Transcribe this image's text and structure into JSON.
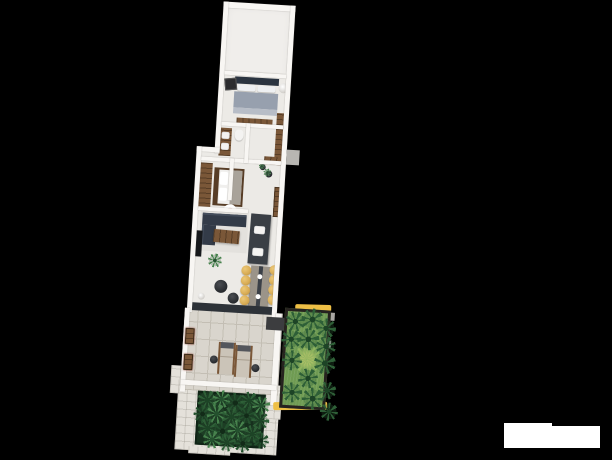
{
  "canvas": {
    "width": 612,
    "height": 460
  },
  "palette": {
    "bg": "#000000",
    "wall": "#f8f6f3",
    "floor": "#eceae6",
    "floorA": "#f0eeeb",
    "rug": "#e3e1dd",
    "patio": "#d9d5cd",
    "patioLine": "#c3beb4",
    "paving": "#e4e1da",
    "navy": "#2b3440",
    "sofa": "#333b48",
    "blanket": "#97a0ae",
    "pillow": "#eef0f2",
    "wood": "#7a5738",
    "woodDark": "#573d26",
    "charcoal": "#3a3f45",
    "tvBlack": "#17191c",
    "tableGrey": "#9b9489",
    "runner": "#3b4047",
    "chairYellow": "#d9ad56",
    "pouf": "#26292d",
    "grass": "#6f9b52",
    "grassLight": "#8fb45e",
    "palm": "#2e5f37",
    "palmDark": "#1d4426",
    "foliageBase": "#16301d",
    "foliageEdge": "#0f2315",
    "gardenBorder": "#26231f",
    "curbYellow": "#eebf45",
    "loungerBeige": "#cbc4b8",
    "greyObj": "#b8b6b2",
    "threshold": "#2d3238",
    "gate": "#3c3d3f",
    "toilet": "#f4f3f1",
    "pinkRug": "#e0b7ad",
    "white": "#ffffff"
  },
  "scene": {
    "rotation_deg": 3.5,
    "right_garden": {
      "palms": [
        {
          "x": 8,
          "y": 10,
          "r": 10,
          "rot": 12
        },
        {
          "x": 25,
          "y": 7,
          "r": 11,
          "rot": 40
        },
        {
          "x": 39,
          "y": 15,
          "r": 10,
          "rot": 80
        },
        {
          "x": 5,
          "y": 28,
          "r": 10,
          "rot": 22
        },
        {
          "x": 22,
          "y": 27,
          "r": 11,
          "rot": 65
        },
        {
          "x": 40,
          "y": 33,
          "r": 10,
          "rot": 5
        },
        {
          "x": 7,
          "y": 49,
          "r": 10,
          "rot": 33
        },
        {
          "x": 40,
          "y": 50,
          "r": 11,
          "rot": 50
        },
        {
          "x": 24,
          "y": 66,
          "r": 10,
          "rot": 15
        },
        {
          "x": 9,
          "y": 81,
          "r": 10,
          "rot": 70
        },
        {
          "x": 30,
          "y": 86,
          "r": 11,
          "rot": 28
        },
        {
          "x": 44,
          "y": 77,
          "r": 9,
          "rot": 55
        },
        {
          "x": 47,
          "y": 98,
          "r": 9,
          "rot": 35
        }
      ],
      "grass_tufts": [
        {
          "x": 22,
          "y": 47,
          "r": 14
        }
      ]
    },
    "bottom_garden": {
      "tufts": [
        {
          "x": 8,
          "y": 7,
          "r": 10,
          "v": "a",
          "rot": 10
        },
        {
          "x": 22,
          "y": 5,
          "r": 9,
          "v": "c",
          "rot": 44
        },
        {
          "x": 36,
          "y": 8,
          "r": 10,
          "v": "b",
          "rot": 70
        },
        {
          "x": 50,
          "y": 5,
          "r": 9,
          "v": "a",
          "rot": 20
        },
        {
          "x": 62,
          "y": 9,
          "r": 9,
          "v": "c",
          "rot": 62
        },
        {
          "x": 4,
          "y": 21,
          "r": 9,
          "v": "b",
          "rot": 30
        },
        {
          "x": 18,
          "y": 20,
          "r": 10,
          "v": "c",
          "rot": 15
        },
        {
          "x": 33,
          "y": 22,
          "r": 10,
          "v": "a",
          "rot": 52
        },
        {
          "x": 48,
          "y": 20,
          "r": 9,
          "v": "b",
          "rot": 5
        },
        {
          "x": 62,
          "y": 24,
          "r": 9,
          "v": "a",
          "rot": 77
        },
        {
          "x": 10,
          "y": 35,
          "r": 10,
          "v": "a",
          "rot": 48
        },
        {
          "x": 25,
          "y": 37,
          "r": 10,
          "v": "b",
          "rot": 24
        },
        {
          "x": 40,
          "y": 35,
          "r": 10,
          "v": "c",
          "rot": 66
        },
        {
          "x": 55,
          "y": 38,
          "r": 9,
          "v": "a",
          "rot": 12
        },
        {
          "x": 64,
          "y": 44,
          "r": 8,
          "v": "b",
          "rot": 39
        },
        {
          "x": 30,
          "y": 48,
          "r": 9,
          "v": "a",
          "rot": 58
        },
        {
          "x": 15,
          "y": 46,
          "r": 9,
          "v": "c",
          "rot": 8
        },
        {
          "x": 46,
          "y": 48,
          "r": 9,
          "v": "b",
          "rot": 31
        }
      ]
    },
    "dining": {
      "chairs": [
        {
          "x": 71,
          "y": 269
        },
        {
          "x": 71,
          "y": 279
        },
        {
          "x": 71,
          "y": 289
        },
        {
          "x": 71,
          "y": 299
        },
        {
          "x": 99,
          "y": 267
        },
        {
          "x": 99,
          "y": 277
        },
        {
          "x": 99,
          "y": 287
        },
        {
          "x": 99,
          "y": 297
        }
      ]
    },
    "house_plants": [
      {
        "x": 39,
        "y": 261,
        "r": 7
      },
      {
        "x": 80,
        "y": 164,
        "r": 3
      },
      {
        "x": 86,
        "y": 170,
        "r": 4
      }
    ]
  },
  "watermark": {
    "present": true
  }
}
